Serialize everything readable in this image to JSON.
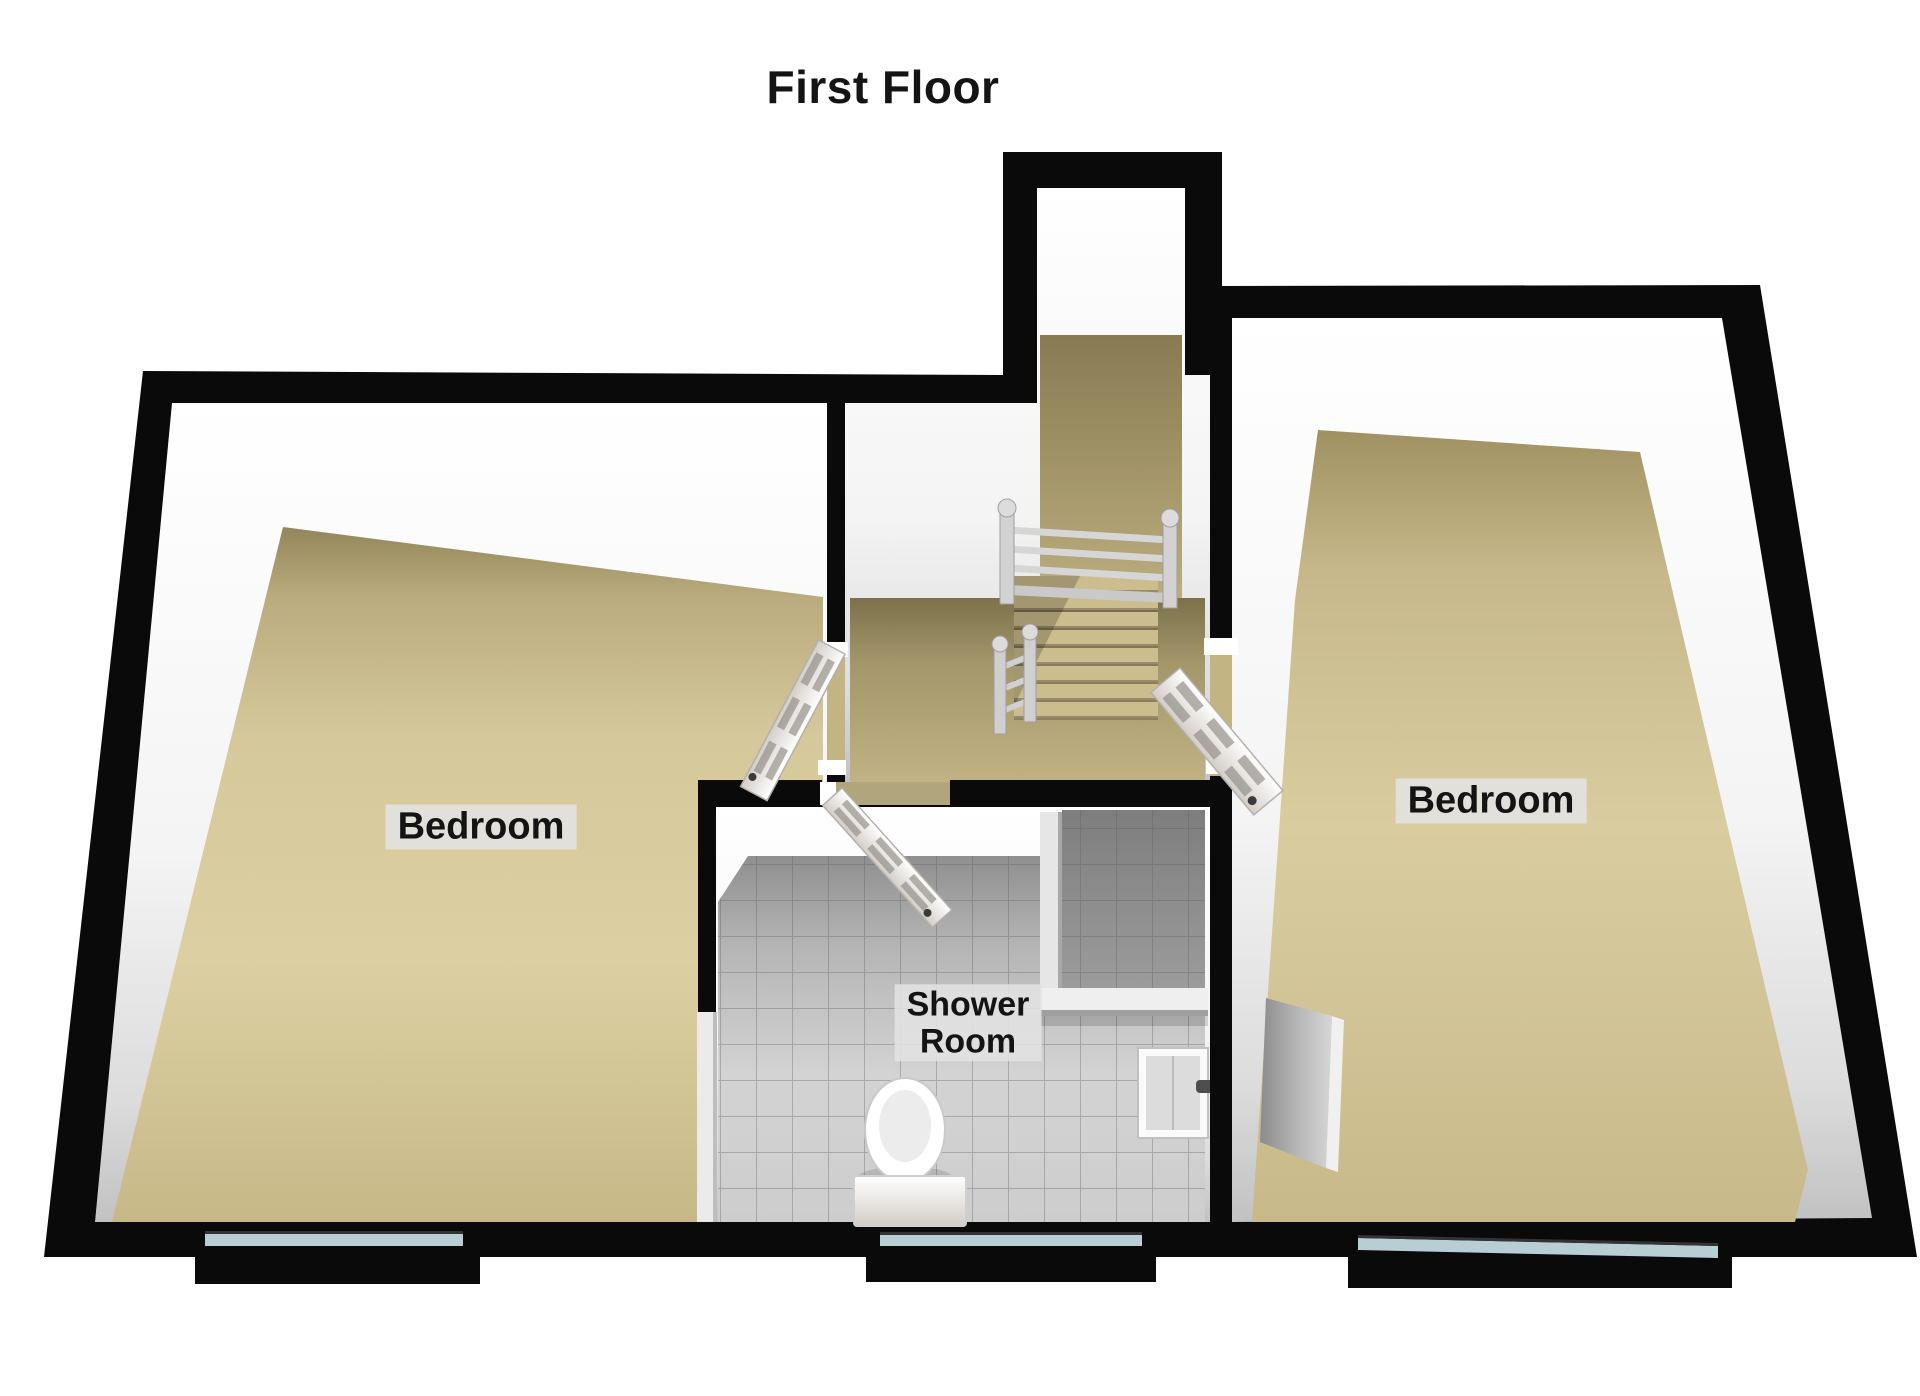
{
  "title": "First Floor",
  "rooms": {
    "bedroom_left": {
      "label": "Bedroom"
    },
    "bedroom_right": {
      "label": "Bedroom"
    },
    "shower_room": {
      "label": "Shower\nRoom"
    }
  },
  "fixtures": [
    "staircase-with-railing",
    "toilet",
    "shower-tray",
    "shower-enclosure",
    "six-panel-doors-open",
    "window-glazing-strips"
  ],
  "colors": {
    "background": "#ffffff",
    "wall": "#0a0a0a",
    "carpet": "#d6c89a",
    "carpet_dark": "#93865a",
    "tile": "#c8c8c8",
    "window_glass": "#b9ced3",
    "label_bg": "#e2e2e2",
    "label_text": "#141414"
  }
}
